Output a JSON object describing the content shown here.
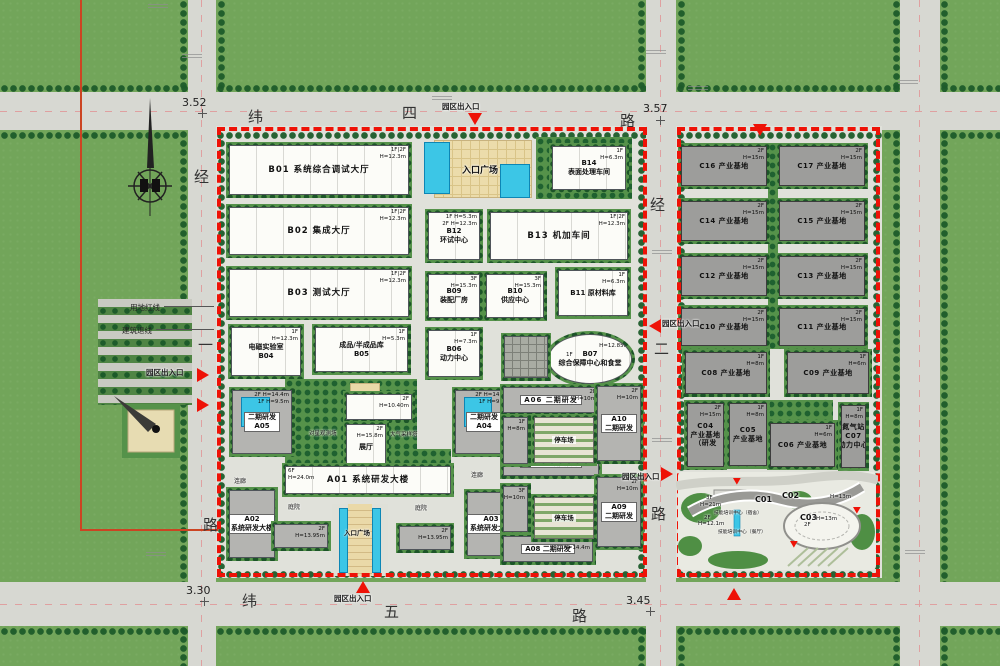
{
  "roads": {
    "top": {
      "c1": "纬",
      "c2": "四",
      "c3": "路",
      "elev_left": "3.52",
      "elev_right": "3.57"
    },
    "bottom": {
      "c1": "纬",
      "c2": "五",
      "c3": "路",
      "elev_left": "3.30",
      "elev_right": "3.45"
    },
    "west": {
      "c1": "经",
      "c2": "一",
      "c3": "路"
    },
    "center": {
      "c1": "经",
      "c2": "二",
      "c3": "路"
    }
  },
  "boundary": {
    "land_line": "用地红线",
    "setback_line": "建筑退线"
  },
  "entrance_label": "园区出入口",
  "entrances": [
    {
      "label": "园区出入口",
      "lx": 442,
      "ly": 101,
      "tx": 468,
      "ty": 113,
      "dir": "down"
    },
    {
      "tx": 753,
      "ty": 124,
      "dir": "down"
    },
    {
      "label": "园区出入口",
      "lx": 146,
      "ly": 367,
      "tx": 197,
      "ty": 368,
      "dir": "right"
    },
    {
      "tx": 197,
      "ty": 398,
      "dir": "right"
    },
    {
      "label": "园区出入口",
      "lx": 662,
      "ly": 318,
      "tx": 649,
      "ty": 319,
      "dir": "left"
    },
    {
      "label": "园区出入口",
      "lx": 622,
      "ly": 471,
      "tx": 661,
      "ty": 467,
      "dir": "right"
    },
    {
      "label": "园区出入口",
      "lx": 334,
      "ly": 593,
      "tx": 356,
      "ty": 581,
      "dir": "up"
    },
    {
      "tx": 727,
      "ty": 588,
      "dir": "up"
    },
    {
      "tx": 733,
      "ty": 478,
      "dir": "down",
      "sm": 1
    },
    {
      "tx": 790,
      "ty": 541,
      "dir": "down",
      "sm": 1
    },
    {
      "tx": 853,
      "ty": 507,
      "dir": "down",
      "sm": 1
    }
  ],
  "buildings": [
    {
      "id": "B01",
      "t": "b",
      "x": 226,
      "y": 142,
      "w": 186,
      "h": 56,
      "lines": [
        "B01  系统综合调试大厅"
      ],
      "ann": [
        "1F|2F",
        "H=12.3m"
      ]
    },
    {
      "id": "B02",
      "t": "b",
      "x": 226,
      "y": 204,
      "w": 186,
      "h": 54,
      "lines": [
        "B02  集成大厅"
      ],
      "ann": [
        "1F|2F",
        "H=12.3m"
      ]
    },
    {
      "id": "B03",
      "t": "b",
      "x": 226,
      "y": 266,
      "w": 186,
      "h": 54,
      "lines": [
        "B03  测试大厅"
      ],
      "ann": [
        "1F|2F",
        "H=12.3m"
      ]
    },
    {
      "id": "B04",
      "t": "b",
      "x": 228,
      "y": 324,
      "w": 76,
      "h": 55,
      "lines": [
        "电磁实验室",
        "B04"
      ],
      "ann": [
        "1F",
        "H=12.3m"
      ]
    },
    {
      "id": "B05",
      "t": "b",
      "x": 312,
      "y": 324,
      "w": 99,
      "h": 51,
      "lines": [
        "成品/半成品库",
        "B05"
      ],
      "ann": [
        "1F",
        "H=5.3m"
      ]
    },
    {
      "id": "B06",
      "t": "b",
      "x": 425,
      "y": 327,
      "w": 58,
      "h": 53,
      "lines": [
        "B06",
        "动力中心"
      ],
      "ann": [
        "1F",
        "H=7.3m"
      ]
    },
    {
      "id": "B07",
      "t": "b",
      "e": 1,
      "x": 545,
      "y": 331,
      "w": 90,
      "h": 56,
      "lines": [
        "B07",
        "综合保障中心和食堂"
      ],
      "ann": [
        "2F",
        "H=12.85m"
      ]
    },
    {
      "id": "B09",
      "t": "b",
      "x": 425,
      "y": 271,
      "w": 58,
      "h": 50,
      "lines": [
        "B09",
        "装配厂房"
      ],
      "ann": [
        "3F",
        "H=15.3m"
      ]
    },
    {
      "id": "B10",
      "t": "b",
      "x": 483,
      "y": 271,
      "w": 64,
      "h": 50,
      "lines": [
        "B10",
        "供应中心"
      ],
      "ann": [
        "3F",
        "H=15.3m"
      ]
    },
    {
      "id": "B11",
      "t": "b",
      "x": 555,
      "y": 267,
      "w": 76,
      "h": 52,
      "lines": [
        "B11 原材料库"
      ],
      "ann": [
        "1F",
        "H=6.3m"
      ]
    },
    {
      "id": "B12",
      "t": "b",
      "x": 425,
      "y": 209,
      "w": 58,
      "h": 54,
      "lines": [
        "B12",
        "环试中心"
      ],
      "ann": [
        "1F H=5.3m",
        "2F H=12.3m"
      ]
    },
    {
      "id": "B13",
      "t": "b",
      "x": 487,
      "y": 209,
      "w": 144,
      "h": 54,
      "lines": [
        "B13  机加车间"
      ],
      "ann": [
        "1F|2F",
        "H=12.3m"
      ]
    },
    {
      "id": "B14",
      "t": "b",
      "x": 549,
      "y": 143,
      "w": 80,
      "h": 50,
      "lines": [
        "B14",
        "表面处理车间"
      ],
      "ann": [
        "1F",
        "H=6.3m"
      ]
    },
    {
      "id": "tower",
      "t": "b",
      "x": 343,
      "y": 391,
      "w": 72,
      "h": 32,
      "lines": [],
      "ann": [
        "2F",
        "H=10.40m"
      ]
    },
    {
      "id": "exhibition-hall",
      "t": "b",
      "x": 343,
      "y": 421,
      "w": 46,
      "h": 52,
      "lines": [
        "展厅"
      ],
      "ann": [
        "2F",
        "H=15.8m"
      ]
    },
    {
      "id": "grid-block",
      "t": "grid",
      "x": 501,
      "y": 333,
      "w": 50,
      "h": 48,
      "lines": []
    },
    {
      "id": "A01",
      "t": "b",
      "x": 282,
      "y": 463,
      "w": 172,
      "h": 34,
      "lines": [
        "A01  系统研发大楼"
      ],
      "ann": [
        "6F",
        "H=24.0m"
      ],
      "ap": "l"
    },
    {
      "id": "A02",
      "t": "a",
      "x": 226,
      "y": 487,
      "w": 52,
      "h": 74,
      "lines": [
        "A02",
        "系统研发大楼"
      ]
    },
    {
      "id": "A03",
      "t": "a",
      "x": 464,
      "y": 489,
      "w": 54,
      "h": 70,
      "lines": [
        "A03",
        "系统研发大楼"
      ]
    },
    {
      "id": "A04",
      "t": "a",
      "x": 452,
      "y": 387,
      "w": 64,
      "h": 70,
      "pool": 1,
      "lines": [
        "二期研发",
        "A04"
      ],
      "ann": [
        "2F H=14.4m",
        "1F H=9.5m"
      ]
    },
    {
      "id": "A05",
      "t": "a",
      "x": 229,
      "y": 387,
      "w": 66,
      "h": 70,
      "pool": 1,
      "lines": [
        "二期研发",
        "A05"
      ],
      "ann": [
        "2F H=14.4m",
        "1F H=9.5m"
      ]
    },
    {
      "id": "A06",
      "t": "a",
      "x": 500,
      "y": 384,
      "w": 102,
      "h": 32,
      "lines": [
        "A06 二期研发"
      ],
      "ann": [
        "2F",
        "H=10m"
      ]
    },
    {
      "id": "A07",
      "t": "a",
      "x": 500,
      "y": 447,
      "w": 102,
      "h": 32,
      "lines": [
        "A07 二期研发"
      ],
      "ann": [
        "2F",
        "H=10m"
      ]
    },
    {
      "id": "A08",
      "t": "a",
      "x": 500,
      "y": 533,
      "w": 96,
      "h": 32,
      "lines": [
        "A08 二期研发"
      ],
      "ann": [
        "3F",
        "H=14.4m"
      ]
    },
    {
      "id": "A09",
      "t": "a",
      "x": 594,
      "y": 474,
      "w": 50,
      "h": 76,
      "lines": [
        "A09",
        "二期研发"
      ],
      "ann": [
        "2F",
        "H=10m"
      ]
    },
    {
      "id": "A10",
      "t": "a",
      "x": 594,
      "y": 383,
      "w": 50,
      "h": 81,
      "lines": [
        "A10",
        "二期研发"
      ],
      "ann": [
        "2F",
        "H=10m"
      ]
    },
    {
      "id": "annex-1F",
      "t": "a",
      "x": 500,
      "y": 414,
      "w": 31,
      "h": 53,
      "lines": [],
      "ann": [
        "1F",
        "H=8m"
      ]
    },
    {
      "id": "annex-3F",
      "t": "a",
      "x": 500,
      "y": 483,
      "w": 31,
      "h": 52,
      "lines": [],
      "ann": [
        "3F",
        "H=10m"
      ]
    },
    {
      "id": "parking-north",
      "t": "p",
      "x": 531,
      "y": 414,
      "w": 66,
      "h": 52,
      "lines": [
        "停车场"
      ]
    },
    {
      "id": "parking-south",
      "t": "p",
      "x": 531,
      "y": 494,
      "w": 66,
      "h": 48,
      "lines": [
        "停车场"
      ]
    },
    {
      "id": "wing-west",
      "t": "a",
      "x": 271,
      "y": 521,
      "w": 60,
      "h": 30,
      "lines": [],
      "ann": [
        "2F",
        "H=13.95m"
      ]
    },
    {
      "id": "wing-east",
      "t": "a",
      "x": 396,
      "y": 523,
      "w": 58,
      "h": 30,
      "lines": [],
      "ann": [
        "2F",
        "H=13.95m"
      ]
    },
    {
      "id": "C16",
      "t": "c",
      "x": 678,
      "y": 143,
      "w": 92,
      "h": 46,
      "lines": [
        "C16 产业基地"
      ],
      "ann": [
        "2F",
        "H=15m"
      ]
    },
    {
      "id": "C17",
      "t": "c",
      "x": 776,
      "y": 143,
      "w": 92,
      "h": 46,
      "lines": [
        "C17 产业基地"
      ],
      "ann": [
        "2F",
        "H=15m"
      ]
    },
    {
      "id": "C14",
      "t": "c",
      "x": 678,
      "y": 198,
      "w": 92,
      "h": 46,
      "lines": [
        "C14 产业基地"
      ],
      "ann": [
        "2F",
        "H=15m"
      ]
    },
    {
      "id": "C15",
      "t": "c",
      "x": 776,
      "y": 198,
      "w": 92,
      "h": 46,
      "lines": [
        "C15 产业基地"
      ],
      "ann": [
        "2F",
        "H=15m"
      ]
    },
    {
      "id": "C12",
      "t": "c",
      "x": 678,
      "y": 253,
      "w": 92,
      "h": 46,
      "lines": [
        "C12 产业基地"
      ],
      "ann": [
        "2F",
        "H=15m"
      ]
    },
    {
      "id": "C13",
      "t": "c",
      "x": 776,
      "y": 253,
      "w": 92,
      "h": 46,
      "lines": [
        "C13 产业基地"
      ],
      "ann": [
        "2F",
        "H=15m"
      ]
    },
    {
      "id": "C10",
      "t": "c",
      "x": 678,
      "y": 305,
      "w": 92,
      "h": 44,
      "lines": [
        "C10 产业基地"
      ],
      "ann": [
        "2F",
        "H=15m"
      ]
    },
    {
      "id": "C11",
      "t": "c",
      "x": 776,
      "y": 305,
      "w": 92,
      "h": 44,
      "lines": [
        "C11 产业基地"
      ],
      "ann": [
        "2F",
        "H=15m"
      ]
    },
    {
      "id": "C08",
      "t": "c",
      "x": 682,
      "y": 349,
      "w": 88,
      "h": 48,
      "lines": [
        "C08 产业基地"
      ],
      "ann": [
        "1F",
        "H=8m"
      ]
    },
    {
      "id": "C09",
      "t": "c",
      "x": 784,
      "y": 349,
      "w": 88,
      "h": 48,
      "lines": [
        "C09 产业基地"
      ],
      "ann": [
        "1F",
        "H=6m"
      ]
    },
    {
      "id": "C04",
      "t": "c",
      "x": 684,
      "y": 400,
      "w": 43,
      "h": 70,
      "lines": [
        "C04",
        "产业基地",
        "（研发"
      ],
      "ann": [
        "2F",
        "H=15m"
      ]
    },
    {
      "id": "C05",
      "t": "c",
      "x": 726,
      "y": 400,
      "w": 44,
      "h": 69,
      "lines": [
        "C05",
        "产业基地"
      ],
      "ann": [
        "1F",
        "H=8m"
      ]
    },
    {
      "id": "C06",
      "t": "c",
      "x": 767,
      "y": 420,
      "w": 71,
      "h": 50,
      "lines": [
        "C06 产业基地"
      ],
      "ann": [
        "1F",
        "H=6m"
      ]
    },
    {
      "id": "C07",
      "t": "c",
      "x": 838,
      "y": 402,
      "w": 31,
      "h": 69,
      "lines": [
        "氮气站",
        "C07",
        "动力中心"
      ],
      "ann": [
        "1F",
        "H=8m"
      ]
    }
  ],
  "labels": [
    {
      "t": "入口广场",
      "x": 462,
      "y": 163,
      "fs": 9,
      "b": 1
    },
    {
      "t": "入口广场",
      "x": 344,
      "y": 527,
      "fs": 6.5,
      "b": 1
    },
    {
      "t": "庭院",
      "x": 288,
      "y": 502,
      "fs": 6
    },
    {
      "t": "庭院",
      "x": 415,
      "y": 503,
      "fs": 6
    },
    {
      "t": "连廊",
      "x": 234,
      "y": 476,
      "fs": 6
    },
    {
      "t": "连廊",
      "x": 471,
      "y": 470,
      "fs": 6
    },
    {
      "t": "对星观测场",
      "x": 309,
      "y": 429,
      "fs": 5.5
    },
    {
      "t": "大气采样塔",
      "x": 390,
      "y": 430,
      "fs": 5.5
    },
    {
      "t": "1F",
      "x": 566,
      "y": 352,
      "fs": 5.5
    },
    {
      "t": "C01",
      "x": 755,
      "y": 495,
      "fs": 8,
      "b": 1
    },
    {
      "t": "C02",
      "x": 782,
      "y": 491,
      "fs": 8,
      "b": 1
    },
    {
      "t": "C03",
      "x": 800,
      "y": 513,
      "fs": 8,
      "b": 1
    },
    {
      "t": "3F",
      "x": 706,
      "y": 495,
      "fs": 5.5
    },
    {
      "t": "H=21m",
      "x": 700,
      "y": 502,
      "fs": 5.5
    },
    {
      "t": "技能培训中心（宿舍）",
      "x": 714,
      "y": 509,
      "fs": 4.8
    },
    {
      "t": "2F",
      "x": 704,
      "y": 515,
      "fs": 5.5
    },
    {
      "t": "H=12.1m",
      "x": 698,
      "y": 521,
      "fs": 5.5
    },
    {
      "t": "技能培训中心（餐厅）",
      "x": 718,
      "y": 528,
      "fs": 4.8
    },
    {
      "t": "H=13m",
      "x": 830,
      "y": 494,
      "fs": 5.5
    },
    {
      "t": "2F",
      "x": 804,
      "y": 522,
      "fs": 5.5
    },
    {
      "t": "H=13m",
      "x": 816,
      "y": 516,
      "fs": 5.5
    }
  ]
}
